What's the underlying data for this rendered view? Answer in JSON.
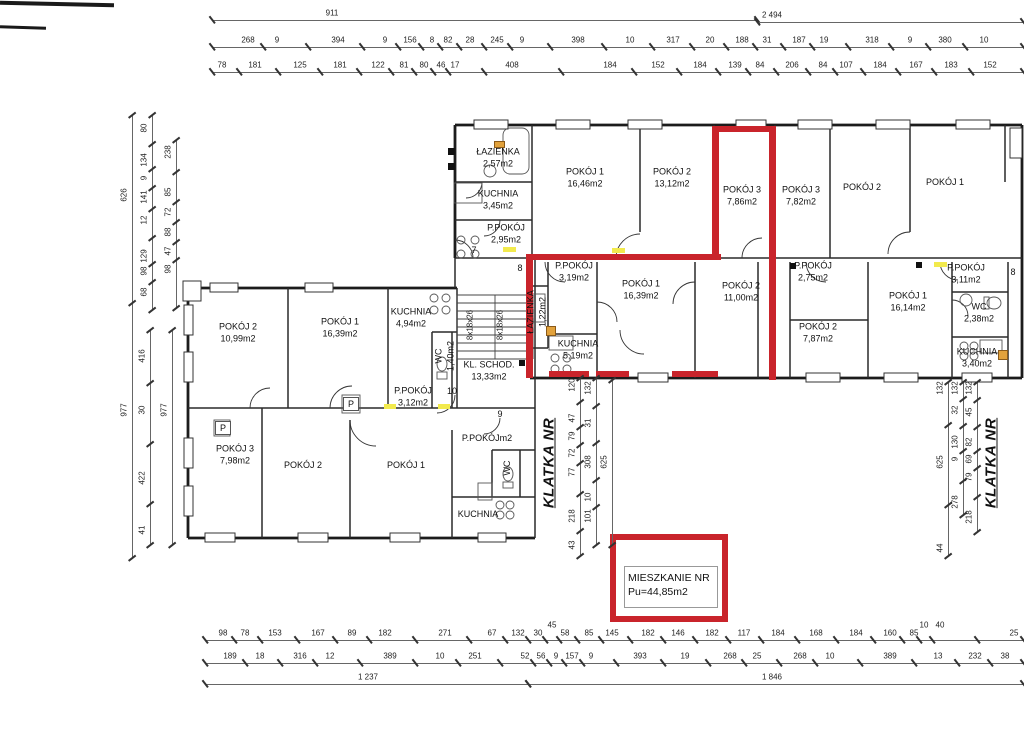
{
  "legend": {
    "line1": "MIESZKANIE NR",
    "line2": "Pu=44,85m2"
  },
  "stairwells": {
    "left": "KLATKA NR",
    "right": "KLATKA NR"
  },
  "rooms": [
    {
      "name": "ŁAZIENKA",
      "area": "2,57m2",
      "x": 498,
      "y": 158
    },
    {
      "name": "KUCHNIA",
      "area": "3,45m2",
      "x": 498,
      "y": 200
    },
    {
      "name": "P.POKÓJ",
      "area": "2,95m2",
      "x": 506,
      "y": 234
    },
    {
      "name": "POKÓJ 1",
      "area": "16,46m2",
      "x": 585,
      "y": 178
    },
    {
      "name": "POKÓJ 2",
      "area": "13,12m2",
      "x": 672,
      "y": 178
    },
    {
      "name": "POKÓJ 3",
      "area": "7,86m2",
      "x": 742,
      "y": 196
    },
    {
      "name": "POKÓJ 3",
      "area": "7,82m2",
      "x": 801,
      "y": 196
    },
    {
      "name": "POKÓJ 2",
      "area": "",
      "x": 862,
      "y": 188
    },
    {
      "name": "POKÓJ 1",
      "area": "",
      "x": 945,
      "y": 183
    },
    {
      "name": "P.POKÓJ",
      "area": "3,19m2",
      "x": 574,
      "y": 272
    },
    {
      "name": "POKÓJ 1",
      "area": "16,39m2",
      "x": 641,
      "y": 290
    },
    {
      "name": "POKÓJ 2",
      "area": "11,00m2",
      "x": 741,
      "y": 292
    },
    {
      "name": "P.POKÓJ",
      "area": "2,75m2",
      "x": 813,
      "y": 272
    },
    {
      "name": "POKÓJ 2",
      "area": "7,87m2",
      "x": 818,
      "y": 333
    },
    {
      "name": "ŁAZIENKA",
      "area": "1,22m2",
      "x": 537,
      "y": 312,
      "rot": true
    },
    {
      "name": "KUCHNIA",
      "area": "5,19m2",
      "x": 578,
      "y": 350
    },
    {
      "name": "POKÓJ 1",
      "area": "16,14m2",
      "x": 908,
      "y": 302
    },
    {
      "name": "P.POKÓJ",
      "area": "3,11m2",
      "x": 966,
      "y": 274
    },
    {
      "name": "WC",
      "area": "2,38m2",
      "x": 979,
      "y": 313
    },
    {
      "name": "KUCHNIA",
      "area": "3,40m2",
      "x": 977,
      "y": 358
    },
    {
      "name": "POKÓJ 2",
      "area": "10,99m2",
      "x": 238,
      "y": 333
    },
    {
      "name": "POKÓJ 1",
      "area": "16,39m2",
      "x": 340,
      "y": 328
    },
    {
      "name": "KUCHNIA",
      "area": "4,94m2",
      "x": 411,
      "y": 318
    },
    {
      "name": "WC",
      "area": "1,40m2",
      "x": 445,
      "y": 356,
      "rot": true
    },
    {
      "name": "KL. SCHOD.",
      "area": "13,33m2",
      "x": 489,
      "y": 371
    },
    {
      "name": "P.POKÓJ",
      "area": "3,12m2",
      "x": 413,
      "y": 397
    },
    {
      "name": "POKÓJ 3",
      "area": "7,98m2",
      "x": 235,
      "y": 455
    },
    {
      "name": "POKÓJ 2",
      "area": "",
      "x": 303,
      "y": 466
    },
    {
      "name": "POKÓJ 1",
      "area": "",
      "x": 406,
      "y": 466
    },
    {
      "name": "P.POKÓJm2",
      "area": "",
      "x": 487,
      "y": 439
    },
    {
      "name": "WC",
      "area": "",
      "x": 508,
      "y": 468,
      "rot": true
    },
    {
      "name": "KUCHNIA",
      "area": "",
      "x": 478,
      "y": 515
    }
  ],
  "markers": [
    {
      "t": "7",
      "x": 474,
      "y": 250
    },
    {
      "t": "8",
      "x": 520,
      "y": 268
    },
    {
      "t": "8",
      "x": 1013,
      "y": 272
    },
    {
      "t": "10",
      "x": 452,
      "y": 391
    },
    {
      "t": "9",
      "x": 500,
      "y": 414
    },
    {
      "t": "P",
      "x": 351,
      "y": 404,
      "boxed": true
    },
    {
      "t": "P",
      "x": 223,
      "y": 428,
      "boxed": true
    }
  ],
  "stair_notes": [
    {
      "t": "8x18x26",
      "x": 470,
      "y": 325
    },
    {
      "t": "8x18x26",
      "x": 500,
      "y": 325
    }
  ],
  "dims": {
    "h": [
      {
        "y": 20,
        "x1": 212,
        "x2": 757,
        "labels": [
          {
            "t": "911",
            "x": 332
          }
        ]
      },
      {
        "y": 22,
        "x1": 757,
        "x2": 1023,
        "labels": [
          {
            "t": "2 494",
            "x": 772
          }
        ]
      },
      {
        "y": 47,
        "x1": 212,
        "x2": 1023,
        "labels": [
          {
            "t": "268",
            "x": 248
          },
          {
            "t": "9",
            "x": 277
          },
          {
            "t": "394",
            "x": 338
          },
          {
            "t": "9",
            "x": 385
          },
          {
            "t": "156",
            "x": 410
          },
          {
            "t": "8",
            "x": 432
          },
          {
            "t": "82",
            "x": 448
          },
          {
            "t": "28",
            "x": 470
          },
          {
            "t": "245",
            "x": 497
          },
          {
            "t": "9",
            "x": 522
          },
          {
            "t": "398",
            "x": 578
          },
          {
            "t": "10",
            "x": 630
          },
          {
            "t": "317",
            "x": 673
          },
          {
            "t": "20",
            "x": 710
          },
          {
            "t": "188",
            "x": 742
          },
          {
            "t": "31",
            "x": 767
          },
          {
            "t": "187",
            "x": 799
          },
          {
            "t": "19",
            "x": 824
          },
          {
            "t": "318",
            "x": 872
          },
          {
            "t": "9",
            "x": 910
          },
          {
            "t": "380",
            "x": 945
          },
          {
            "t": "10",
            "x": 984
          }
        ]
      },
      {
        "y": 72,
        "x1": 212,
        "x2": 1023,
        "labels": [
          {
            "t": "78",
            "x": 222
          },
          {
            "t": "181",
            "x": 255
          },
          {
            "t": "125",
            "x": 300
          },
          {
            "t": "181",
            "x": 340
          },
          {
            "t": "122",
            "x": 378
          },
          {
            "t": "81",
            "x": 404
          },
          {
            "t": "80",
            "x": 424
          },
          {
            "t": "46",
            "x": 441
          },
          {
            "t": "17",
            "x": 455
          },
          {
            "t": "408",
            "x": 512
          },
          {
            "t": "184",
            "x": 610
          },
          {
            "t": "152",
            "x": 658
          },
          {
            "t": "184",
            "x": 700
          },
          {
            "t": "139",
            "x": 735
          },
          {
            "t": "84",
            "x": 760
          },
          {
            "t": "206",
            "x": 792
          },
          {
            "t": "84",
            "x": 823
          },
          {
            "t": "107",
            "x": 846
          },
          {
            "t": "184",
            "x": 880
          },
          {
            "t": "167",
            "x": 916
          },
          {
            "t": "183",
            "x": 951
          },
          {
            "t": "152",
            "x": 990
          }
        ]
      },
      {
        "y": 640,
        "x1": 205,
        "x2": 1023,
        "labels": [
          {
            "t": "98",
            "x": 223
          },
          {
            "t": "78",
            "x": 245
          },
          {
            "t": "153",
            "x": 275
          },
          {
            "t": "167",
            "x": 318
          },
          {
            "t": "89",
            "x": 352
          },
          {
            "t": "182",
            "x": 385
          },
          {
            "t": "271",
            "x": 445
          },
          {
            "t": "67",
            "x": 492
          },
          {
            "t": "132",
            "x": 518
          },
          {
            "t": "30",
            "x": 538
          },
          {
            "t": "45",
            "x": 552,
            "dy": -8
          },
          {
            "t": "58",
            "x": 565
          },
          {
            "t": "85",
            "x": 589
          },
          {
            "t": "145",
            "x": 612
          },
          {
            "t": "182",
            "x": 648
          },
          {
            "t": "146",
            "x": 678
          },
          {
            "t": "182",
            "x": 712
          },
          {
            "t": "117",
            "x": 744
          },
          {
            "t": "184",
            "x": 778
          },
          {
            "t": "168",
            "x": 816
          },
          {
            "t": "184",
            "x": 856
          },
          {
            "t": "160",
            "x": 890
          },
          {
            "t": "85",
            "x": 914
          },
          {
            "t": "10",
            "x": 924,
            "dy": -8
          },
          {
            "t": "40",
            "x": 940,
            "dy": -8
          },
          {
            "t": "25",
            "x": 1014
          }
        ]
      },
      {
        "y": 663,
        "x1": 205,
        "x2": 1023,
        "labels": [
          {
            "t": "189",
            "x": 230
          },
          {
            "t": "18",
            "x": 260
          },
          {
            "t": "316",
            "x": 300
          },
          {
            "t": "12",
            "x": 330
          },
          {
            "t": "389",
            "x": 390
          },
          {
            "t": "10",
            "x": 440
          },
          {
            "t": "251",
            "x": 475
          },
          {
            "t": "52",
            "x": 525
          },
          {
            "t": "56",
            "x": 541
          },
          {
            "t": "9",
            "x": 556
          },
          {
            "t": "157",
            "x": 572
          },
          {
            "t": "9",
            "x": 591
          },
          {
            "t": "393",
            "x": 640
          },
          {
            "t": "19",
            "x": 685
          },
          {
            "t": "268",
            "x": 730
          },
          {
            "t": "25",
            "x": 757
          },
          {
            "t": "268",
            "x": 800
          },
          {
            "t": "10",
            "x": 830
          },
          {
            "t": "389",
            "x": 890
          },
          {
            "t": "13",
            "x": 938
          },
          {
            "t": "232",
            "x": 975
          },
          {
            "t": "38",
            "x": 1005
          }
        ]
      },
      {
        "y": 684,
        "x1": 205,
        "x2": 528,
        "labels": [
          {
            "t": "1 237",
            "x": 368
          }
        ]
      },
      {
        "y": 684,
        "x1": 528,
        "x2": 1023,
        "labels": [
          {
            "t": "1 846",
            "x": 772
          }
        ]
      }
    ],
    "v": [
      {
        "x": 132,
        "y1": 115,
        "y2": 558,
        "labels": [
          {
            "t": "626",
            "y": 195
          },
          {
            "t": "977",
            "y": 410
          }
        ]
      },
      {
        "x": 152,
        "y1": 115,
        "y2": 310,
        "labels": [
          {
            "t": "80",
            "y": 128
          },
          {
            "t": "134",
            "y": 160
          },
          {
            "t": "9",
            "y": 178
          },
          {
            "t": "141",
            "y": 197
          },
          {
            "t": "12",
            "y": 220
          },
          {
            "t": "129",
            "y": 256
          },
          {
            "t": "98",
            "y": 271
          },
          {
            "t": "68",
            "y": 292
          }
        ]
      },
      {
        "x": 176,
        "y1": 140,
        "y2": 308,
        "labels": [
          {
            "t": "238",
            "y": 152
          },
          {
            "t": "85",
            "y": 192
          },
          {
            "t": "72",
            "y": 212
          },
          {
            "t": "88",
            "y": 232
          },
          {
            "t": "47",
            "y": 251
          },
          {
            "t": "98",
            "y": 269
          }
        ]
      },
      {
        "x": 150,
        "y1": 330,
        "y2": 545,
        "labels": [
          {
            "t": "416",
            "y": 356
          },
          {
            "t": "30",
            "y": 410
          },
          {
            "t": "422",
            "y": 478
          },
          {
            "t": "41",
            "y": 530
          }
        ]
      },
      {
        "x": 172,
        "y1": 330,
        "y2": 545,
        "labels": [
          {
            "t": "977",
            "y": 410
          }
        ]
      },
      {
        "x": 580,
        "y1": 378,
        "y2": 556,
        "labels": [
          {
            "t": "120",
            "y": 385
          },
          {
            "t": "47",
            "y": 418
          },
          {
            "t": "79",
            "y": 436
          },
          {
            "t": "72",
            "y": 453
          },
          {
            "t": "77",
            "y": 472
          },
          {
            "t": "218",
            "y": 516
          },
          {
            "t": "43",
            "y": 545
          }
        ]
      },
      {
        "x": 596,
        "y1": 378,
        "y2": 545,
        "labels": [
          {
            "t": "132",
            "y": 388
          },
          {
            "t": "31",
            "y": 423
          },
          {
            "t": "308",
            "y": 462
          },
          {
            "t": "10",
            "y": 497
          },
          {
            "t": "101",
            "y": 516
          }
        ]
      },
      {
        "x": 612,
        "y1": 380,
        "y2": 545,
        "labels": [
          {
            "t": "625",
            "y": 462
          }
        ]
      },
      {
        "x": 948,
        "y1": 382,
        "y2": 556,
        "labels": [
          {
            "t": "132",
            "y": 388
          },
          {
            "t": "625",
            "y": 462
          },
          {
            "t": "44",
            "y": 548
          }
        ]
      },
      {
        "x": 963,
        "y1": 382,
        "y2": 515,
        "labels": [
          {
            "t": "132",
            "y": 388
          },
          {
            "t": "32",
            "y": 410
          },
          {
            "t": "130",
            "y": 442
          },
          {
            "t": "9",
            "y": 459
          },
          {
            "t": "278",
            "y": 502
          }
        ]
      },
      {
        "x": 977,
        "y1": 382,
        "y2": 532,
        "labels": [
          {
            "t": "132",
            "y": 388
          },
          {
            "t": "45",
            "y": 412
          },
          {
            "t": "82",
            "y": 442
          },
          {
            "t": "69",
            "y": 459
          },
          {
            "t": "79",
            "y": 477
          },
          {
            "t": "218",
            "y": 517
          }
        ]
      }
    ]
  },
  "klatka_pos": {
    "left": {
      "x": 549,
      "y": 463
    },
    "right": {
      "x": 991,
      "y": 463
    }
  }
}
